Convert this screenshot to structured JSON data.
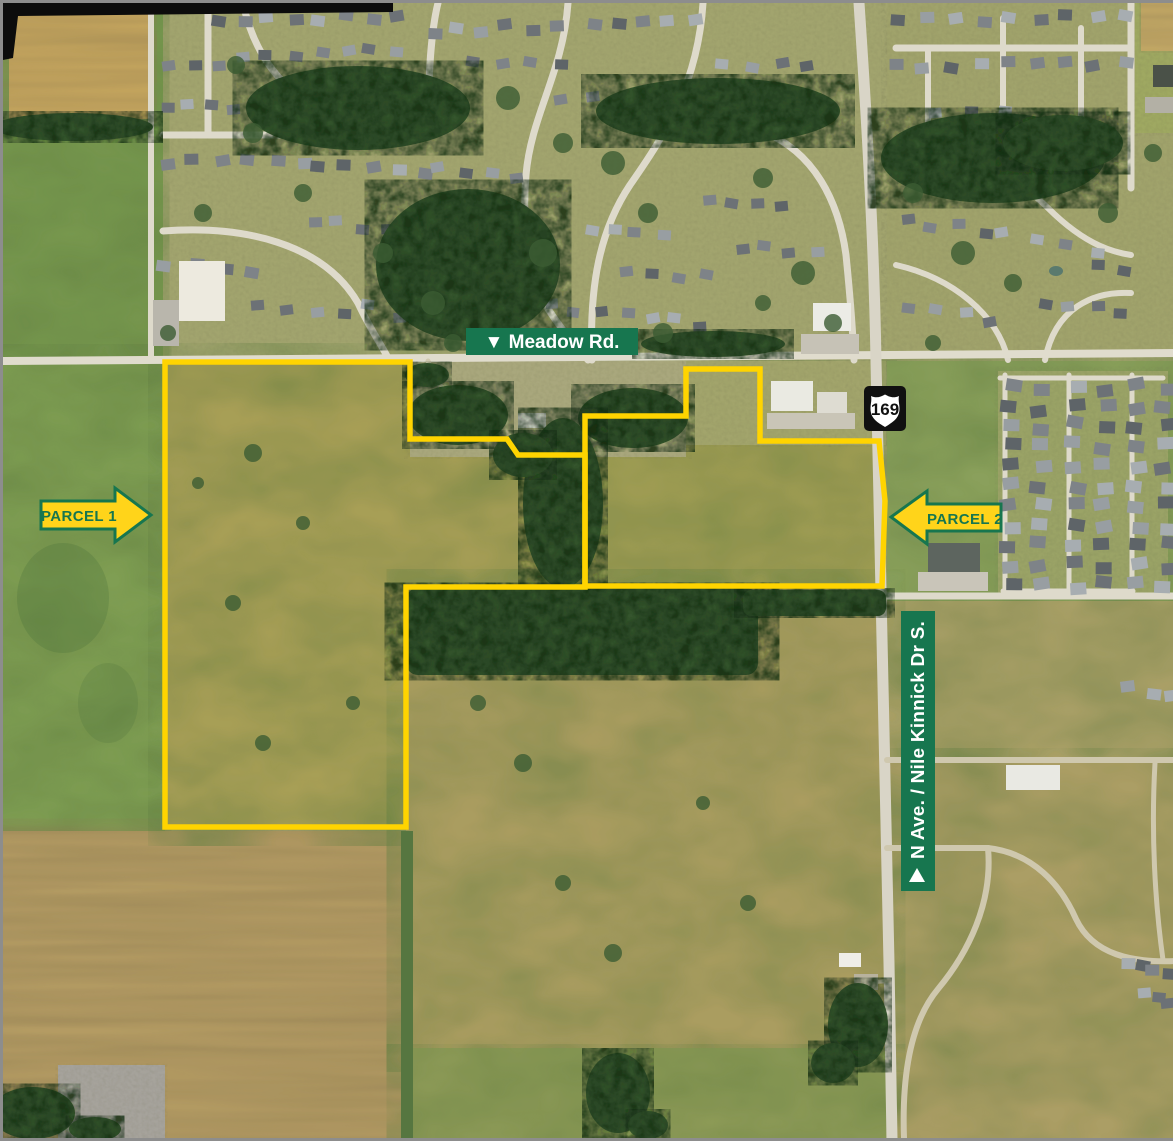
{
  "overlay": {
    "road_label": "▼ Meadow Rd.",
    "parcel_1": "PARCEL 1",
    "parcel_2": "PARCEL 2",
    "route_shield": "169",
    "street_label": "N Ave. / Nile Kinnick Dr S.",
    "street_label_arrow": "▲"
  },
  "colors": {
    "annotation_green": "#17764F",
    "boundary_yellow": "#FFD400",
    "arrow_fill": "#FFD41A",
    "shield_bg": "#101010",
    "shield_face": "#FFFFFF"
  },
  "parcels": [
    {
      "name": "Parcel 1",
      "outline": [
        [
          162,
          359
        ],
        [
          407,
          359
        ],
        [
          407,
          436
        ],
        [
          504,
          436
        ],
        [
          515,
          452
        ],
        [
          582,
          452
        ],
        [
          582,
          584
        ],
        [
          403,
          584
        ],
        [
          403,
          824
        ],
        [
          162,
          824
        ]
      ]
    },
    {
      "name": "Parcel 2",
      "outline": [
        [
          683,
          366
        ],
        [
          757,
          366
        ],
        [
          757,
          438
        ],
        [
          876,
          438
        ],
        [
          882,
          498
        ],
        [
          879,
          583
        ],
        [
          582,
          583
        ],
        [
          582,
          413
        ],
        [
          683,
          413
        ]
      ]
    }
  ]
}
